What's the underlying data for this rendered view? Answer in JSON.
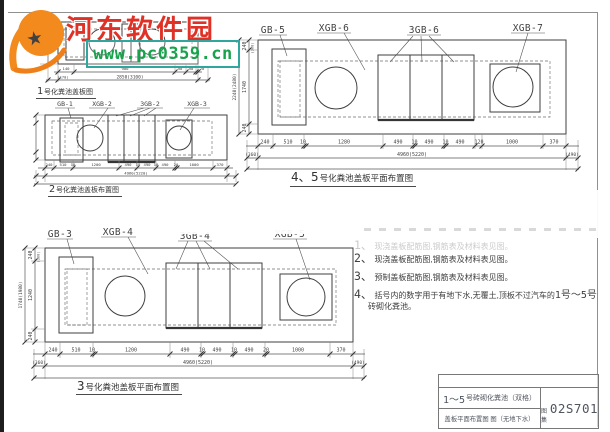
{
  "watermark": {
    "site": "河东软件园",
    "url": "www.pc0359.cn"
  },
  "colors": {
    "logo_orange": "#f28a1e",
    "site_red": "#e03127",
    "url_green": "#17a24c",
    "box_teal": "#2fa79e"
  },
  "d1": {
    "caption_num": "1",
    "caption_rest": "号化粪池盖板图",
    "dims": [
      "140",
      "900",
      "90",
      "90",
      "20"
    ],
    "sub_left": "(170)",
    "total": "2850(3100)"
  },
  "d2": {
    "caption_num": "2",
    "caption_rest": "号化粪池盖板布置图",
    "labels": [
      "GB-1",
      "XGB-2",
      "3GB-2",
      "XGB-3"
    ],
    "dims": [
      "240",
      "510",
      "10",
      "1200",
      "490",
      "10",
      "490",
      "10",
      "490",
      "20",
      "1000",
      "370"
    ],
    "total": "4960(5220)"
  },
  "d45": {
    "caption_num": "4、5",
    "caption_rest": "号化粪池盖板平面布置图",
    "labels": [
      "GB-5",
      "XGB-6",
      "3GB-6",
      "XGB-7"
    ],
    "dims": [
      "240",
      "510",
      "10",
      "1280",
      "490",
      "10",
      "490",
      "10",
      "490",
      "120",
      "1000",
      "370"
    ],
    "sub": [
      "(360)",
      "4960(5220)",
      "(490)"
    ],
    "left_dims": [
      "240",
      "1740",
      "240"
    ],
    "left_small": "(300)",
    "left_total": "2240(2480)"
  },
  "d3": {
    "caption_num": "3",
    "caption_rest": "号化粪池盖板平面布置图",
    "labels": [
      "GB-3",
      "XGB-4",
      "3GB-4",
      "XGB-5"
    ],
    "dims": [
      "240",
      "510",
      "10",
      "1200",
      "490",
      "10",
      "490",
      "10",
      "490",
      "20",
      "1000",
      "370"
    ],
    "sub": [
      "(360)",
      "4960(5220)",
      "(490)"
    ],
    "left_dims": [
      "240",
      "1240",
      "240"
    ],
    "left_small": "(300)",
    "left_total": "1740(1980)"
  },
  "notes": {
    "n1_num": "1、",
    "n1": "现浇盖板配筋图,钢筋表及材料表见图。",
    "n2_num": "2、",
    "n2": "现浇盖板配筋图,钢筋表及材料表见图。",
    "n3_num": "3、",
    "n3": "预制盖板配筋图,钢筋表及材料表见图。",
    "n4_num": "4、",
    "n4a": "括号内的数字用于有地下水,无覆土,顶板不过汽车的",
    "n4_range": "1号～5号",
    "n4b": "砖砌化粪池。"
  },
  "title_block": {
    "row1_num": "1～5",
    "row1": "号砖砌化粪池（双格）",
    "row2": "盖板平面布置图 图（无地下水）",
    "atlas_label": "图集",
    "atlas_code": "02S701"
  }
}
